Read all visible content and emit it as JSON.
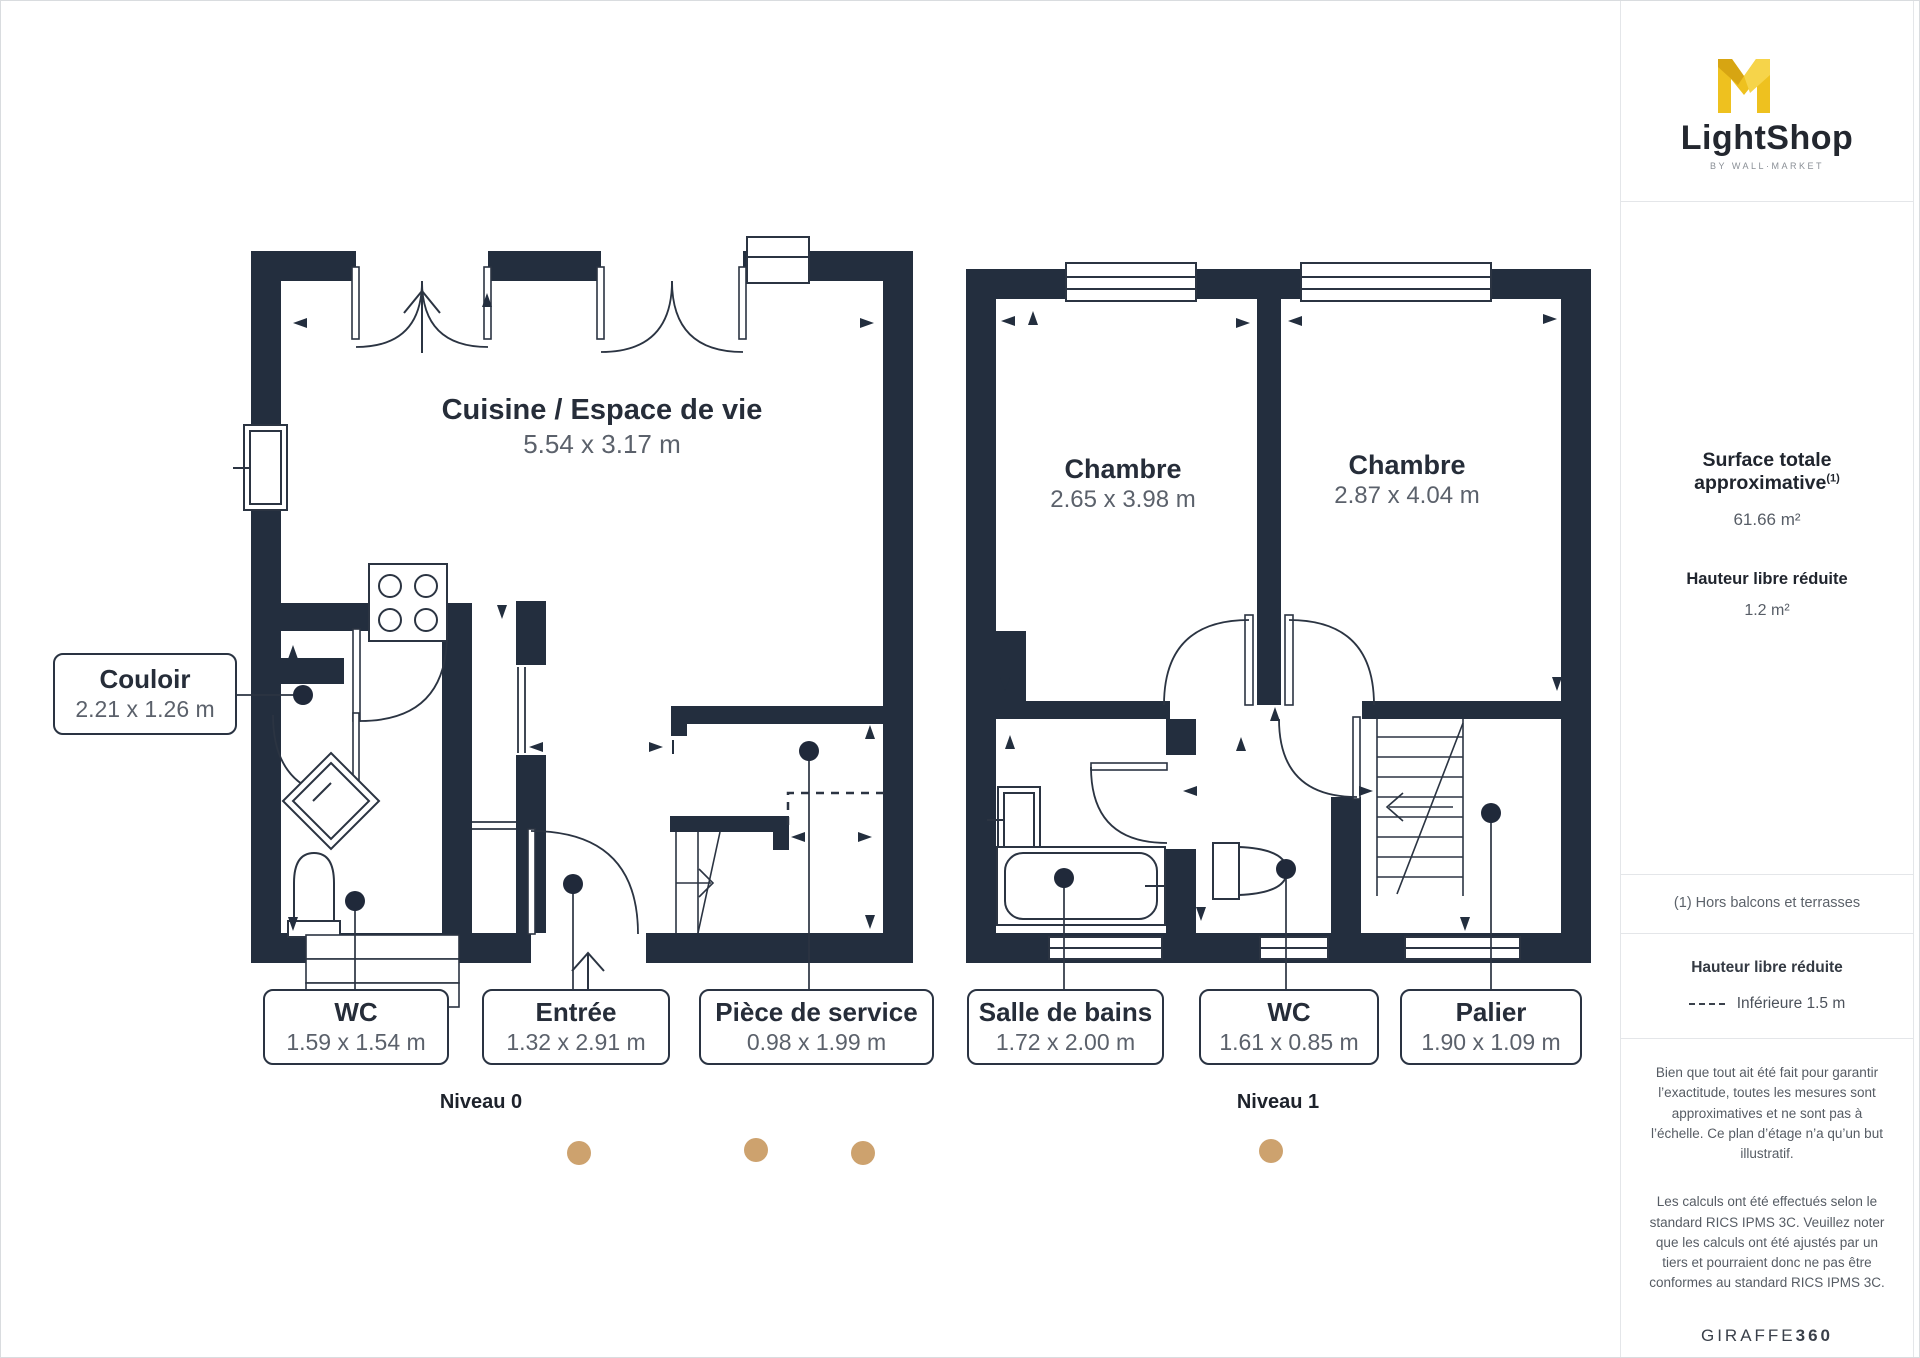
{
  "branding": {
    "logo_text": "LightShop",
    "logo_tagline": "BY WALL·MARKET",
    "footer_logo_regular": "GIRAFFE",
    "footer_logo_bold": "360"
  },
  "sidebar": {
    "surface_title": "Surface totale approximative",
    "surface_sup": "(1)",
    "surface_value": "61.66 m²",
    "reduced_height_title": "Hauteur libre réduite",
    "reduced_height_value": "1.2 m²",
    "footnote": "(1) Hors balcons et terrasses",
    "legend_title": "Hauteur libre réduite",
    "legend_value": "Inférieure 1.5 m",
    "disclaimer1": "Bien que tout ait été fait pour garantir l’exactitude, toutes les mesures sont approximatives et ne sont pas à l’échelle. Ce plan d’étage n’a qu’un but illustratif.",
    "disclaimer2": "Les calculs ont été effectués selon le standard RICS IPMS 3C. Veuillez noter que les calculs ont été ajustés par un tiers et pourraient donc ne pas être conformes au standard RICS IPMS 3C."
  },
  "floor0": {
    "name": "Niveau 0",
    "rooms": [
      {
        "label": "Cuisine / Espace de vie",
        "dims": "5.54 x 3.17 m"
      },
      {
        "label": "Couloir",
        "dims": "2.21 x 1.26 m"
      },
      {
        "label": "WC",
        "dims": "1.59 x 1.54 m"
      },
      {
        "label": "Entrée",
        "dims": "1.32 x 2.91 m"
      },
      {
        "label": "Pièce de service",
        "dims": "0.98 x 1.99 m"
      }
    ]
  },
  "floor1": {
    "name": "Niveau 1",
    "rooms": [
      {
        "label": "Chambre",
        "dims": "2.65 x 3.98 m"
      },
      {
        "label": "Chambre",
        "dims": "2.87 x 4.04 m"
      },
      {
        "label": "Salle de bains",
        "dims": "1.72 x 2.00 m"
      },
      {
        "label": "WC",
        "dims": "1.61 x 0.85 m"
      },
      {
        "label": "Palier",
        "dims": "1.90 x 1.09 m"
      }
    ]
  },
  "colors": {
    "wall": "#232e3e",
    "line": "#2b3442",
    "camera_dot": "#cda26e",
    "logo_gold": "#eec11f",
    "logo_gold_dark": "#d7a512"
  }
}
